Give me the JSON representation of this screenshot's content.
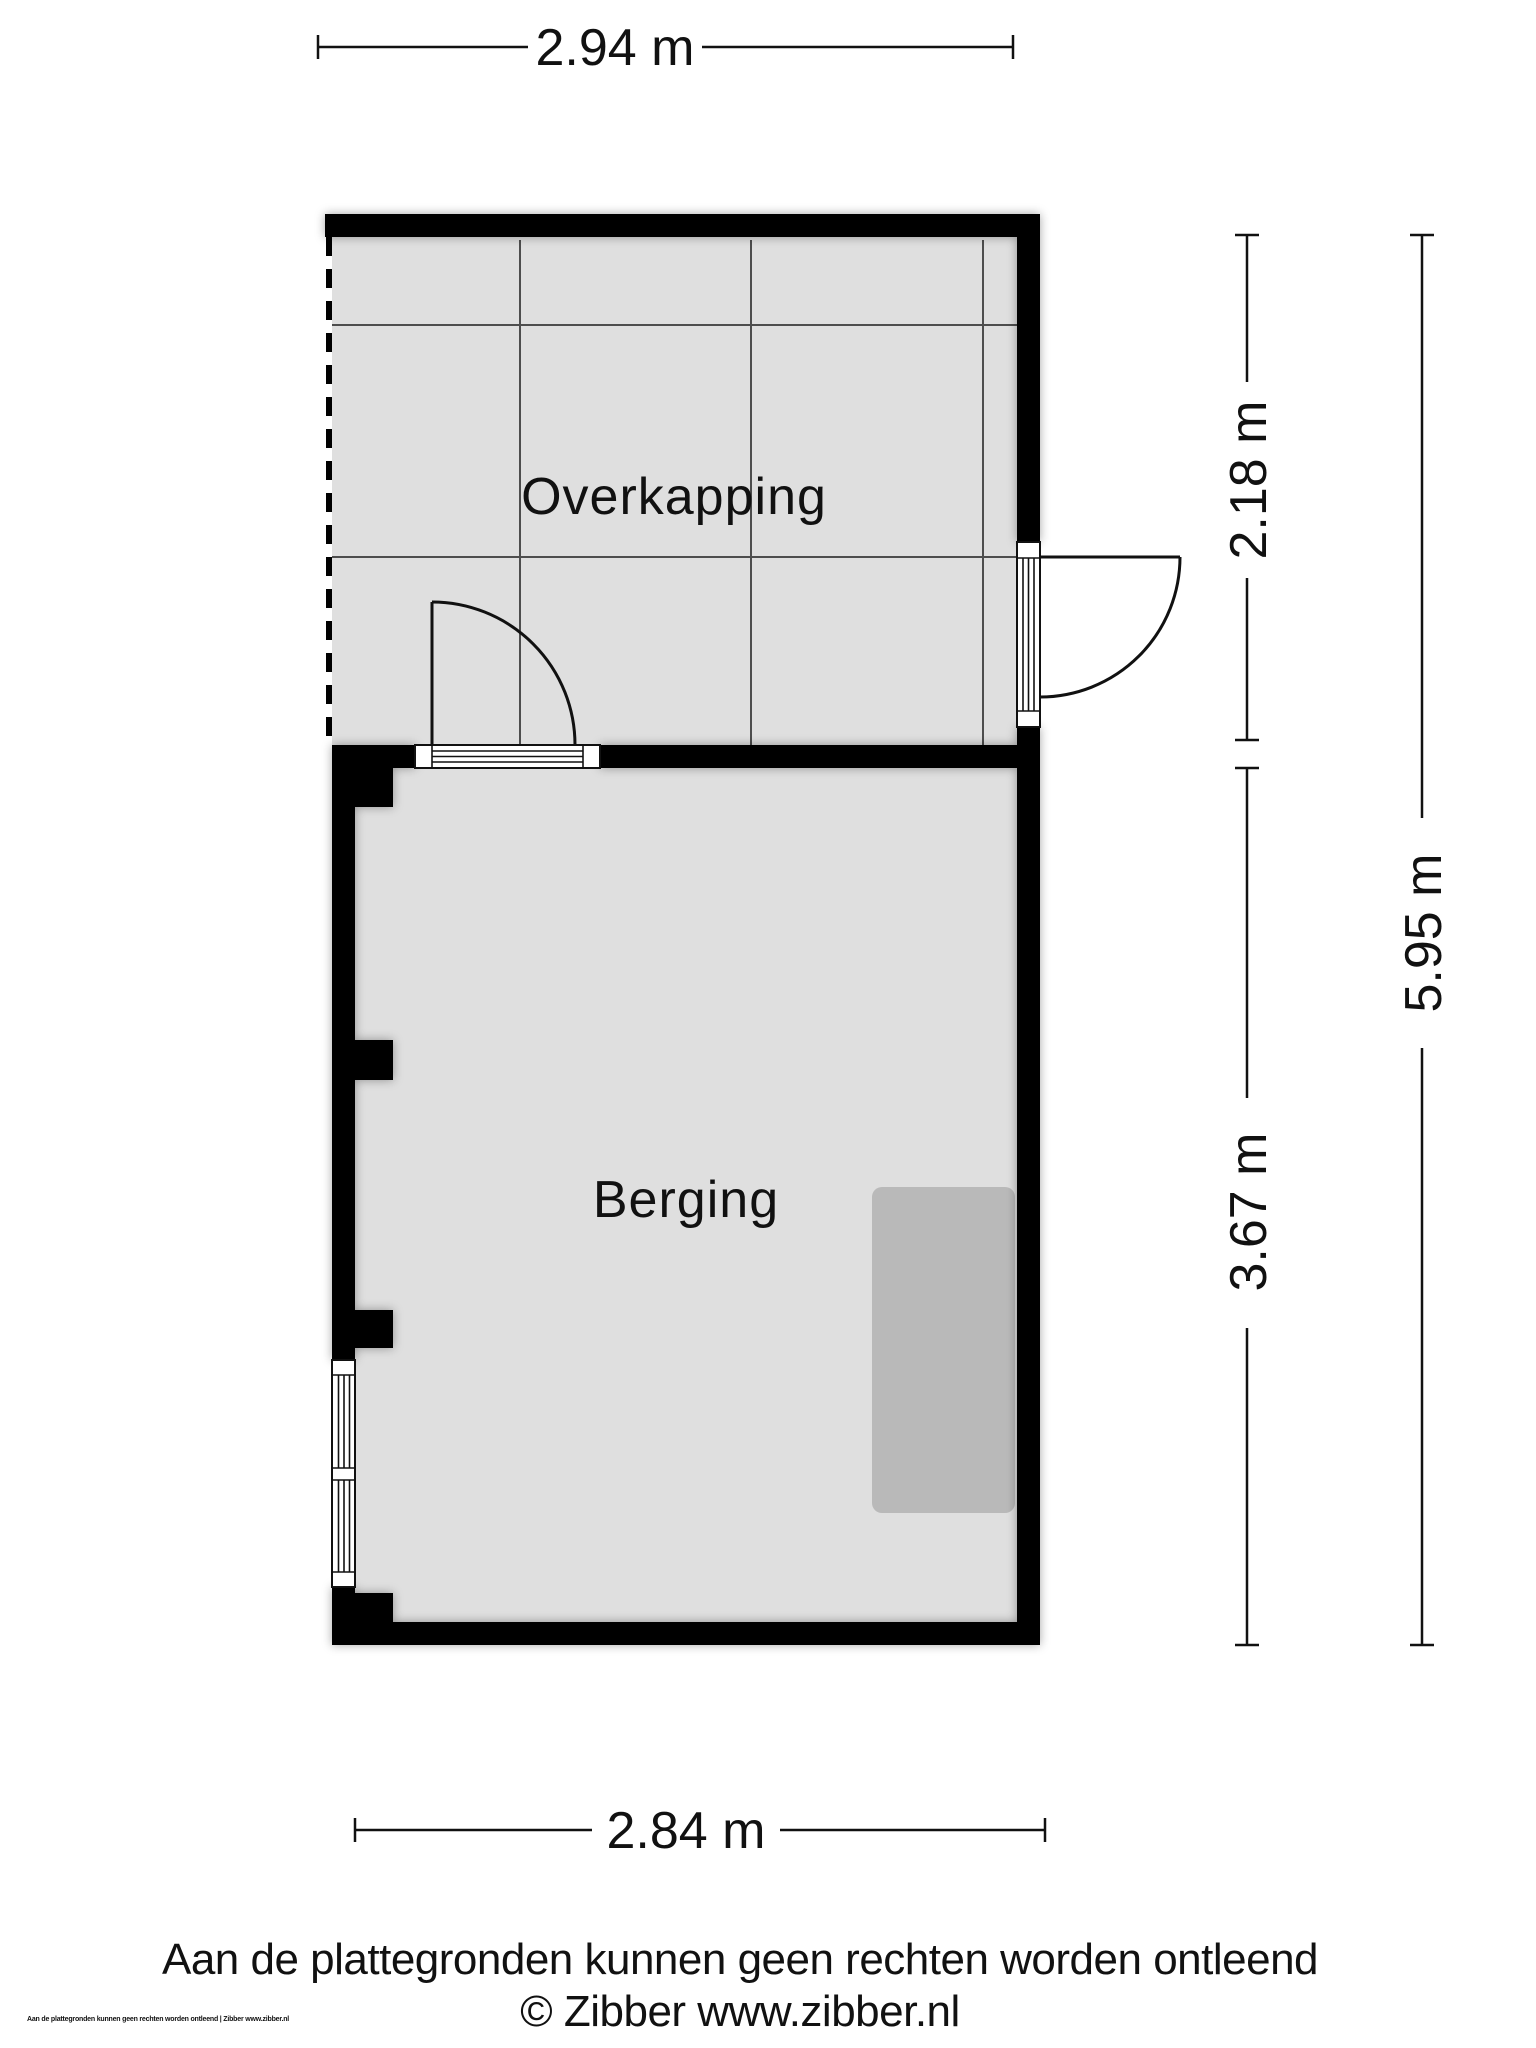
{
  "rooms": [
    {
      "name": "Overkapping"
    },
    {
      "name": "Berging"
    }
  ],
  "dimensions": {
    "top": "2.94 m",
    "right_upper": "2.18 m",
    "right_full": "5.95 m",
    "right_lower": "3.67 m",
    "bottom": "2.84 m"
  },
  "footer": {
    "disclaimer": "Aan de plattegronden kunnen geen rechten worden ontleend",
    "copyright": "© Zibber www.zibber.nl",
    "fine_print": "Aan de plattegronden kunnen geen rechten worden ontleend | Zibber www.zibber.nl"
  },
  "colors": {
    "background": "#ffffff",
    "wall": "#000000",
    "floor": "#dfdfdf",
    "grid_line": "#4d4d4d",
    "object": "#b9b9b9",
    "dimension_line": "#111111"
  }
}
